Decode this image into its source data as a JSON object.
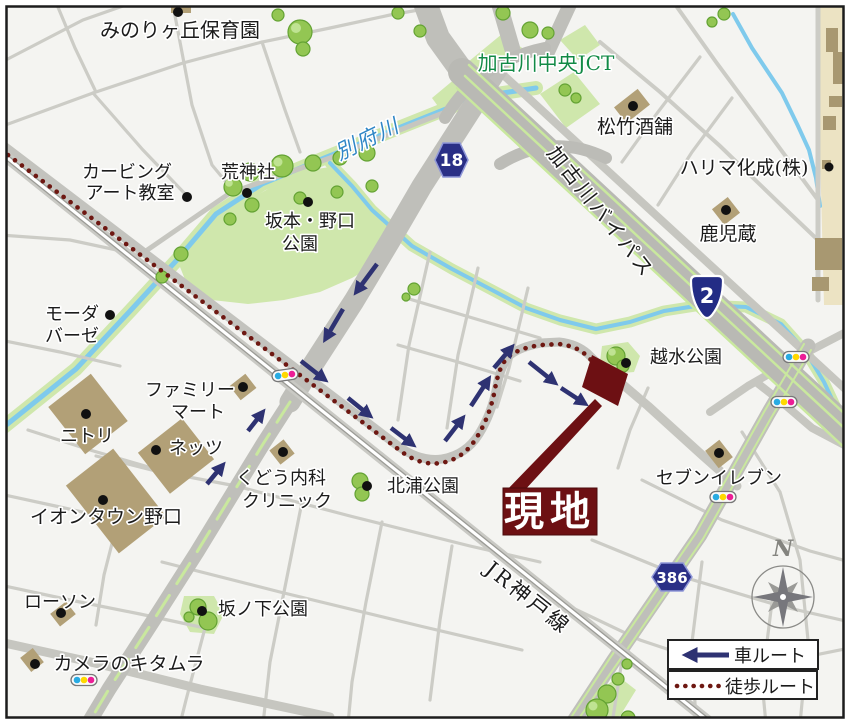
{
  "pois": {
    "minorigaoka_nursery": {
      "label": "みのりヶ丘保育園"
    },
    "kakogawa_chuo_jct": {
      "label": "加古川中央JCT"
    },
    "shochiku_sakaho": {
      "label": "松竹酒舗"
    },
    "harima_kasei": {
      "label": "ハリマ化成(株)"
    },
    "kajigura": {
      "label": "鹿児蔵"
    },
    "carving_art_school": {
      "line1": "カービング",
      "line2": "アート教室"
    },
    "kojinja_shrine": {
      "label": "荒神社"
    },
    "sakamoto_noguchi_park": {
      "line1": "坂本・野口",
      "line2": "公園"
    },
    "moda_baze": {
      "line1": "モーダ",
      "line2": "バーゼ"
    },
    "family_mart": {
      "line1": "ファミリー",
      "line2": "マート"
    },
    "nitori": {
      "label": "ニトリ"
    },
    "netz": {
      "label": "ネッツ"
    },
    "aeon_town_noguchi": {
      "label": "イオンタウン野口"
    },
    "kudo_clinic": {
      "line1": "くどう内科",
      "line2": "クリニック"
    },
    "kitaura_park": {
      "label": "北浦公園"
    },
    "koshimizu_park": {
      "label": "越水公園"
    },
    "seven_eleven": {
      "label": "セブンイレブン"
    },
    "lawson": {
      "label": "ローソン"
    },
    "camera_kitamura": {
      "label": "カメラのキタムラ"
    },
    "sakanoshita_park": {
      "label": "坂ノ下公園"
    }
  },
  "roads": {
    "beppu_river": "別府川",
    "kakogawa_bypass": "加古川バイパス",
    "jr_kobe_line": "JR神戸線"
  },
  "route_badges": {
    "prefectural_18": "18",
    "national_2": "2",
    "prefectural_386": "386"
  },
  "site": {
    "label": "現地"
  },
  "legend": {
    "car_route": "車ルート",
    "walk_route": "徒歩ルート"
  },
  "compass": {
    "north": "N"
  },
  "colors": {
    "site_maroon": "#6d1013",
    "walk_route_maroon": "#6e1812",
    "car_route_navy": "#2e3272",
    "badge_blue": "#2a2f86",
    "jct_green": "#128a46",
    "river_blue": "#7fcaec",
    "park_green": "#cfe7ac",
    "building_tan": "#b2a077",
    "road_gray": "#bfbfba"
  },
  "icons": [
    "tree-icon",
    "building-dot-icon",
    "traffic-light-icon",
    "compass-rose-icon",
    "car-route-arrow-icon",
    "walk-route-dots-icon",
    "site-marker-icon",
    "route-badge-icon"
  ]
}
